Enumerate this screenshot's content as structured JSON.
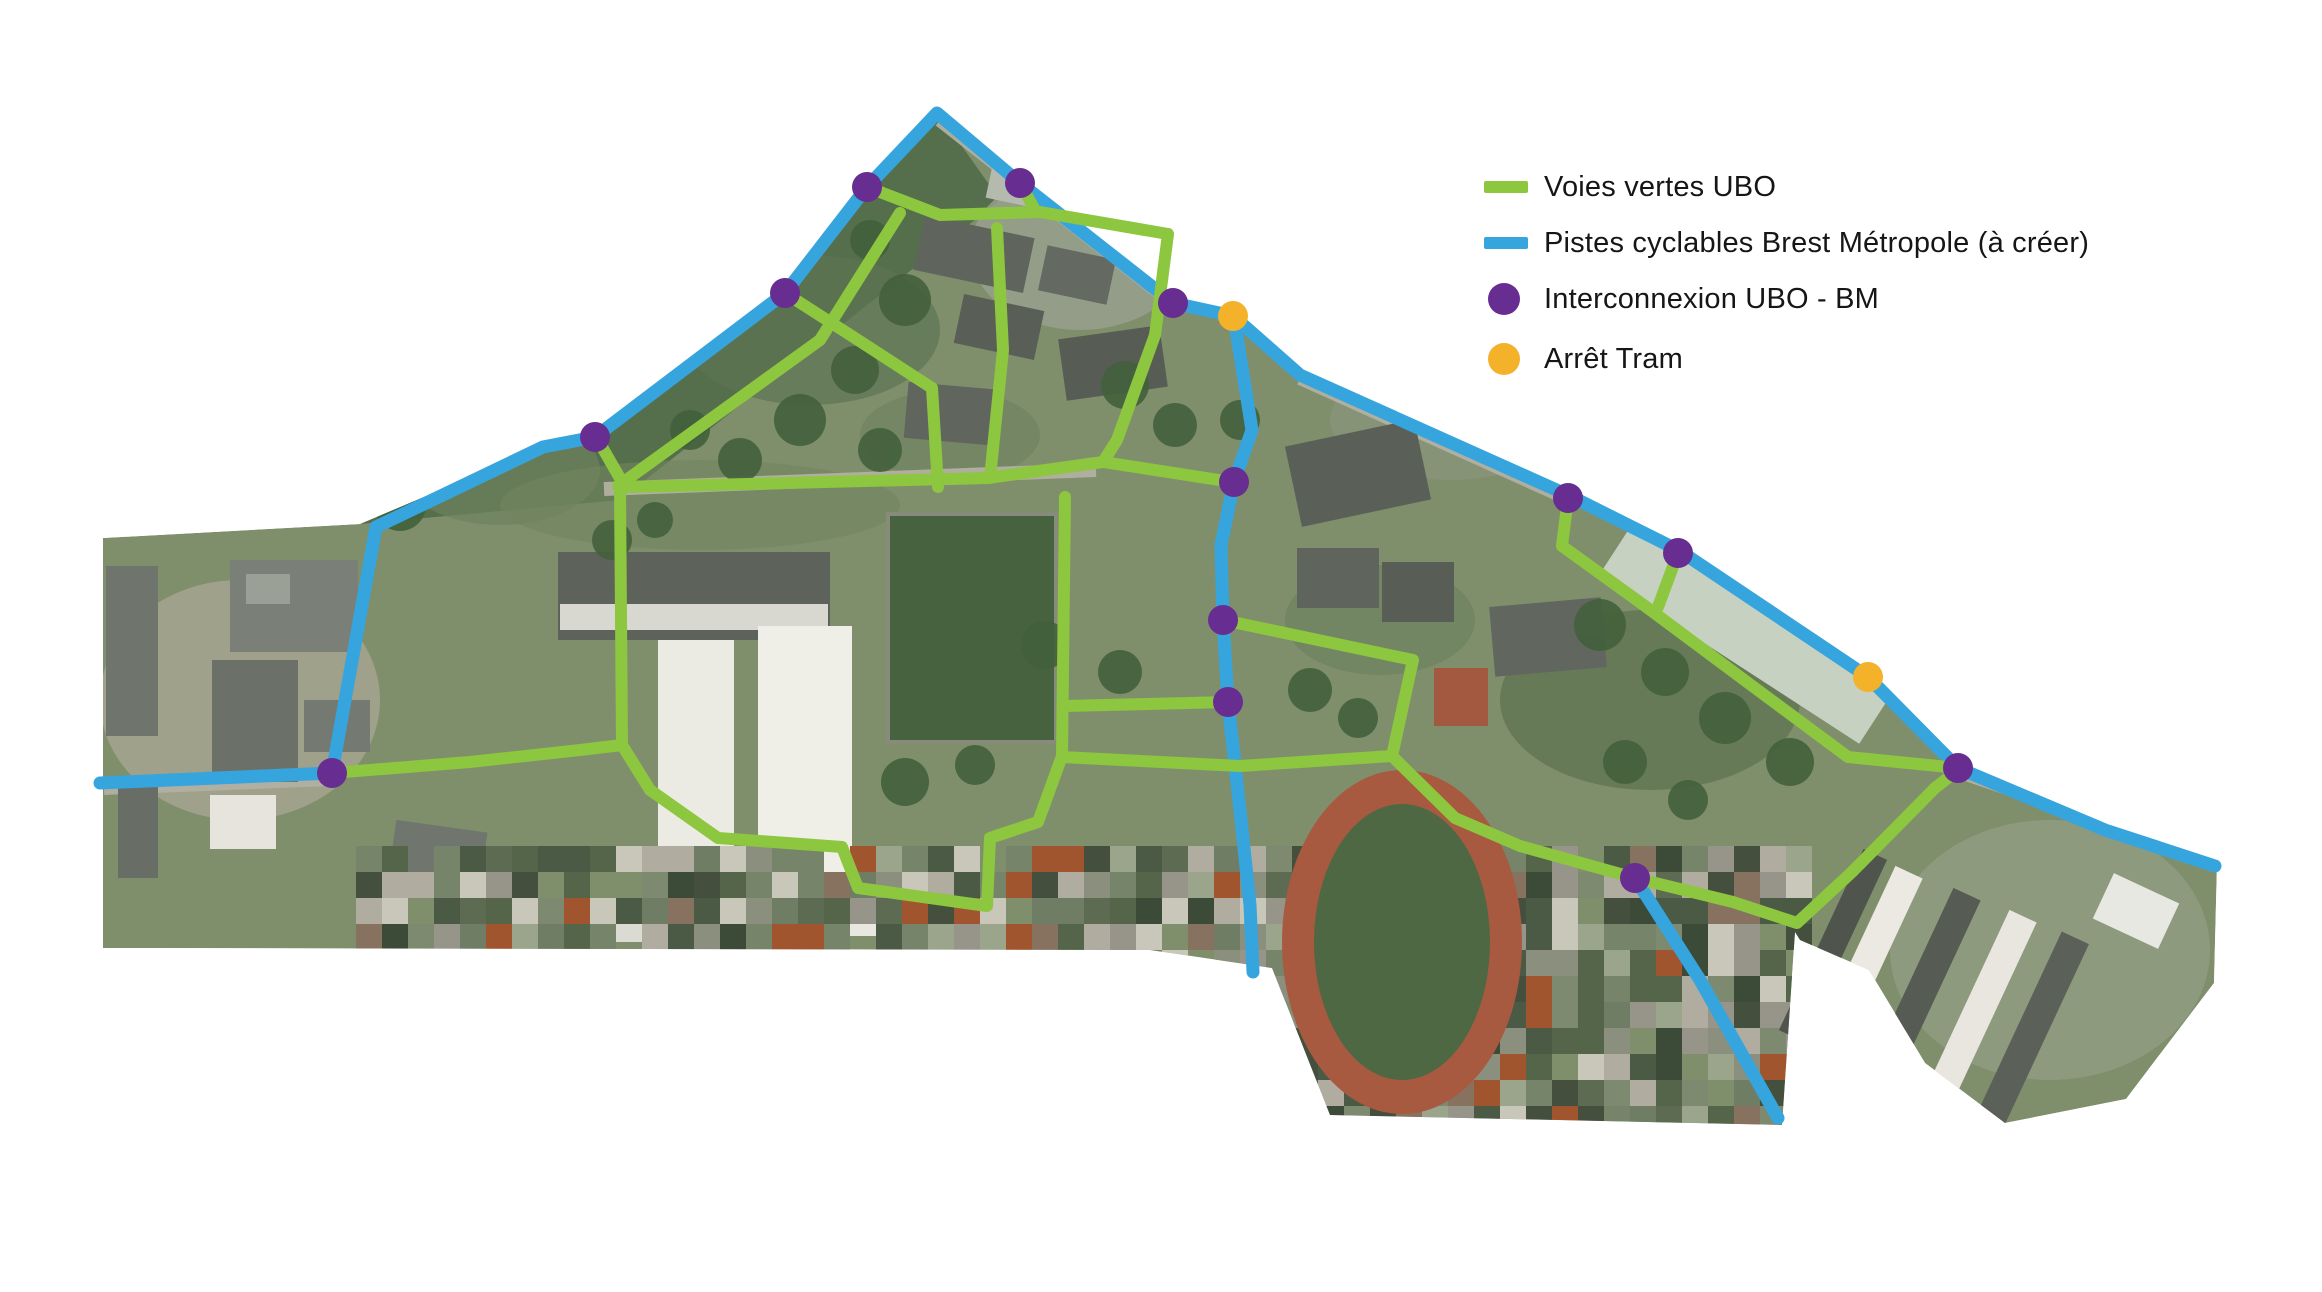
{
  "legend": {
    "items": [
      {
        "id": "voies-vertes-ubo",
        "swatch": "line",
        "color": "#8dc63f",
        "label": "Voies vertes UBO"
      },
      {
        "id": "pistes-cyclables-bm",
        "swatch": "line",
        "color": "#36a5de",
        "label": "Pistes cyclables Brest Métropole (à créer)"
      },
      {
        "id": "interconnexion-ubo-bm",
        "swatch": "dot",
        "color": "#672d91",
        "label": "Interconnexion UBO - BM"
      },
      {
        "id": "arret-tram",
        "swatch": "dot",
        "color": "#f3b229",
        "label": "Arrêt Tram"
      }
    ]
  },
  "map_overlay": {
    "colors": {
      "green": "#8dc63f",
      "blue": "#36a5de",
      "purple": "#672d91",
      "yellow": "#f3b229"
    },
    "line_width": {
      "green": 12,
      "blue": 13
    },
    "dot_radius": 15,
    "blue_paths": [
      [
        [
          100,
          783
        ],
        [
          332,
          773
        ],
        [
          376,
          527
        ],
        [
          543,
          447
        ],
        [
          595,
          437
        ],
        [
          785,
          293
        ],
        [
          867,
          187
        ],
        [
          937,
          113
        ],
        [
          1020,
          183
        ],
        [
          1173,
          303
        ],
        [
          1233,
          316
        ],
        [
          1300,
          375
        ],
        [
          1570,
          496
        ],
        [
          1680,
          551
        ],
        [
          1868,
          677
        ],
        [
          1958,
          768
        ],
        [
          2105,
          830
        ],
        [
          2215,
          866
        ]
      ],
      [
        [
          1236,
          330
        ],
        [
          1252,
          430
        ],
        [
          1234,
          482
        ],
        [
          1221,
          545
        ],
        [
          1223,
          620
        ],
        [
          1228,
          702
        ],
        [
          1240,
          810
        ],
        [
          1250,
          905
        ],
        [
          1253,
          972
        ]
      ],
      [
        [
          1635,
          878
        ],
        [
          1700,
          980
        ],
        [
          1778,
          1118
        ]
      ]
    ],
    "green_paths": [
      [
        [
          867,
          187
        ],
        [
          940,
          215
        ],
        [
          1040,
          212
        ],
        [
          1168,
          234
        ]
      ],
      [
        [
          1020,
          183
        ],
        [
          1035,
          210
        ]
      ],
      [
        [
          1168,
          234
        ],
        [
          1155,
          335
        ],
        [
          1117,
          440
        ],
        [
          1103,
          462
        ],
        [
          1232,
          482
        ]
      ],
      [
        [
          1103,
          462
        ],
        [
          988,
          478
        ],
        [
          625,
          487
        ],
        [
          598,
          440
        ]
      ],
      [
        [
          990,
          478
        ],
        [
          1003,
          350
        ],
        [
          997,
          228
        ]
      ],
      [
        [
          900,
          213
        ],
        [
          820,
          340
        ],
        [
          618,
          486
        ]
      ],
      [
        [
          785,
          293
        ],
        [
          858,
          340
        ],
        [
          932,
          388
        ],
        [
          938,
          487
        ]
      ],
      [
        [
          620,
          487
        ],
        [
          622,
          745
        ]
      ],
      [
        [
          332,
          773
        ],
        [
          470,
          762
        ],
        [
          580,
          750
        ],
        [
          622,
          745
        ]
      ],
      [
        [
          622,
          745
        ],
        [
          650,
          790
        ],
        [
          718,
          838
        ],
        [
          842,
          847
        ],
        [
          858,
          888
        ],
        [
          987,
          906
        ],
        [
          990,
          838
        ],
        [
          1038,
          822
        ],
        [
          1062,
          756
        ]
      ],
      [
        [
          1062,
          756
        ],
        [
          1065,
          497
        ]
      ],
      [
        [
          1065,
          706
        ],
        [
          1228,
          702
        ]
      ],
      [
        [
          1062,
          757
        ],
        [
          1240,
          766
        ],
        [
          1392,
          756
        ]
      ],
      [
        [
          1223,
          620
        ],
        [
          1413,
          660
        ],
        [
          1392,
          756
        ]
      ],
      [
        [
          1392,
          756
        ],
        [
          1455,
          818
        ],
        [
          1520,
          846
        ],
        [
          1635,
          878
        ],
        [
          1733,
          902
        ],
        [
          1797,
          923
        ],
        [
          1852,
          872
        ],
        [
          1935,
          788
        ],
        [
          1958,
          770
        ]
      ],
      [
        [
          1568,
          498
        ],
        [
          1562,
          546
        ],
        [
          1645,
          606
        ],
        [
          1755,
          688
        ],
        [
          1848,
          757
        ],
        [
          1958,
          768
        ]
      ],
      [
        [
          1678,
          553
        ],
        [
          1658,
          607
        ]
      ]
    ],
    "purple_dots": [
      [
        867,
        187
      ],
      [
        1020,
        183
      ],
      [
        785,
        293
      ],
      [
        595,
        437
      ],
      [
        1173,
        303
      ],
      [
        1234,
        482
      ],
      [
        1223,
        620
      ],
      [
        1228,
        702
      ],
      [
        1568,
        498
      ],
      [
        1678,
        553
      ],
      [
        332,
        773
      ],
      [
        1635,
        878
      ],
      [
        1958,
        768
      ]
    ],
    "yellow_dots": [
      [
        1233,
        316
      ],
      [
        1868,
        677
      ]
    ]
  }
}
